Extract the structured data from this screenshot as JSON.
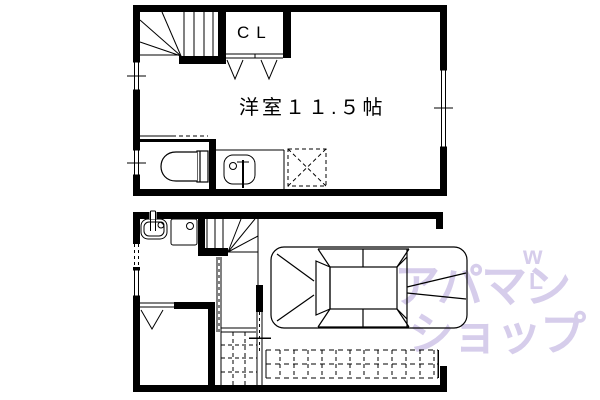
{
  "labels": {
    "closet": "CL",
    "room": "洋室１１.５帖"
  },
  "watermark": {
    "line1": "アパマン",
    "line2": "ショップ",
    "mark_top": "w",
    "mark_bottom": "L",
    "color": "#d6cdeb"
  },
  "colors": {
    "background": "#ffffff",
    "line": "#000000"
  }
}
